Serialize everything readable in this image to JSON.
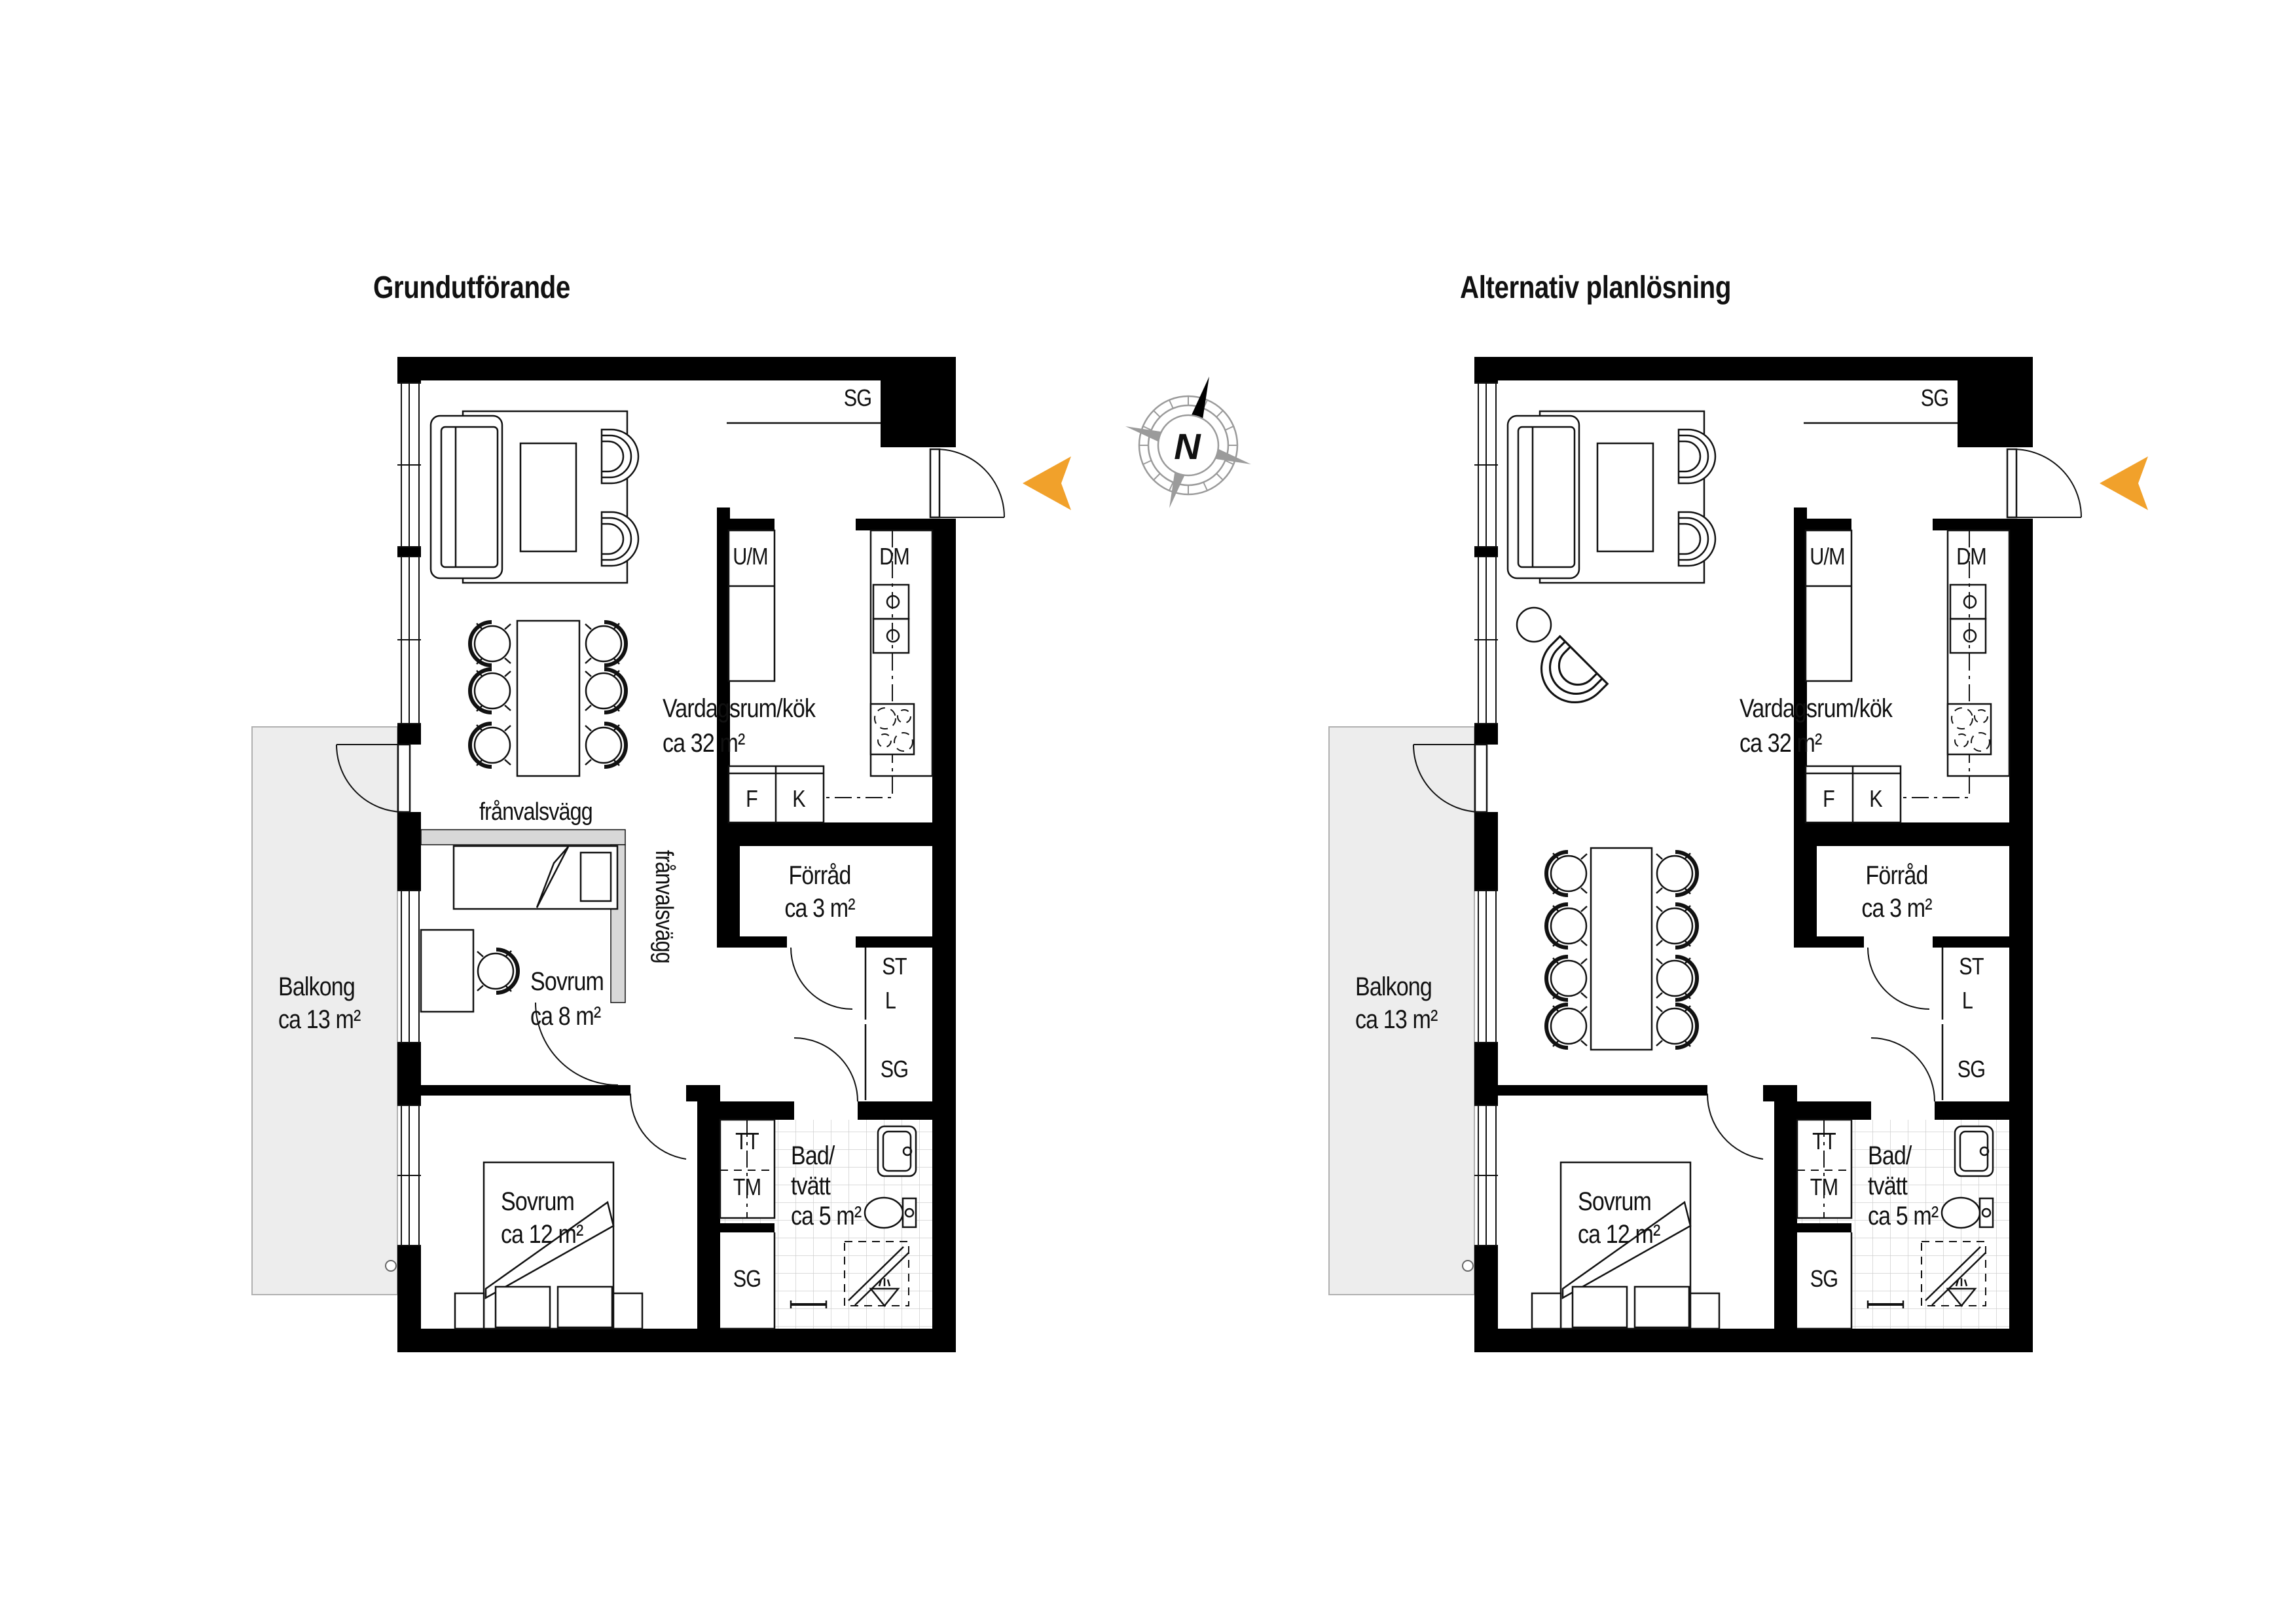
{
  "titles": {
    "left": "Grundutförande",
    "right": "Alternativ planlösning"
  },
  "compass": {
    "north_label": "N"
  },
  "colors": {
    "accent_orange": "#f1a12b",
    "wall_black": "#000000",
    "balcony_gray": "#ededed",
    "optout_wall_gray": "#d8d8d8"
  },
  "rooms": {
    "living": {
      "name": "Vardagsrum/kök",
      "area": "ca 32 m²"
    },
    "bedroom_small": {
      "name": "Sovrum",
      "area": "ca 8 m²"
    },
    "bedroom_large": {
      "name": "Sovrum",
      "area": "ca 12 m²"
    },
    "balcony": {
      "name": "Balkong",
      "area": "ca 13 m²"
    },
    "storage": {
      "name": "Förråd",
      "area": "ca 3 m²"
    },
    "bathroom": {
      "name_line1": "Bad/",
      "name_line2": "tvätt",
      "area": "ca 5 m²"
    }
  },
  "fixtures": {
    "sg": "SG",
    "um": "U/M",
    "dm": "DM",
    "f": "F",
    "k": "K",
    "st": "ST",
    "l": "L",
    "tt": "TT",
    "tm": "TM"
  },
  "annotations": {
    "optout_wall": "frånvalsvägg"
  }
}
